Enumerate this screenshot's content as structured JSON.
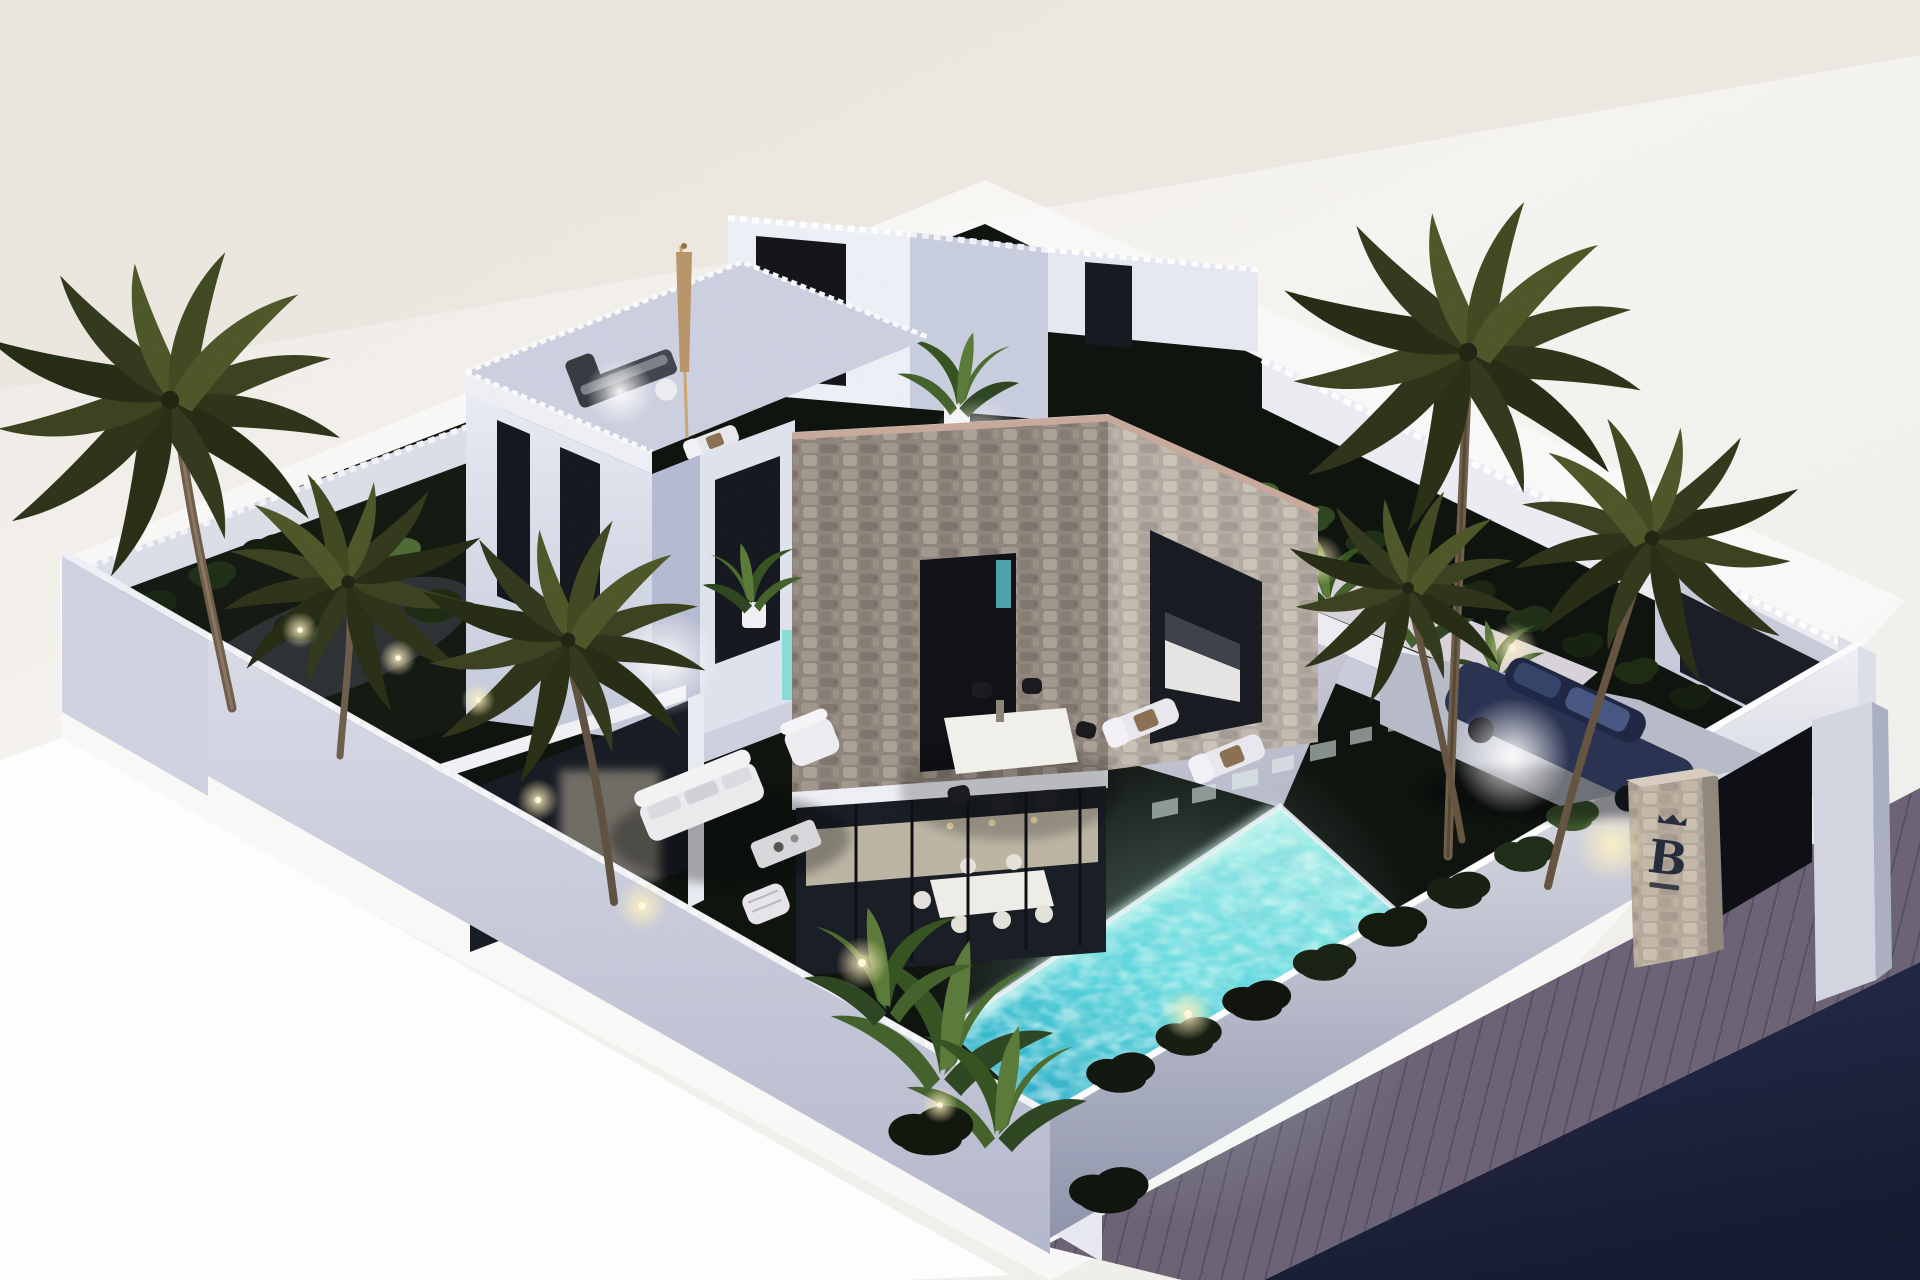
{
  "scene": {
    "title": "Villa B — 3D exterior render at dusk",
    "sign": {
      "letter": "B"
    },
    "palette": {
      "background": "#f2efea",
      "background_bright": "#fbfaf8",
      "lawn": "#0b100b",
      "garden_bed": "#11160f",
      "terrace": "#c9c9da",
      "porch_floor": "#cfd0e0",
      "walkway": "#d8d2da",
      "pool_light": "#aef4ea",
      "pool_deep": "#149bc0",
      "wall_face": "#c6c9d8",
      "wall_coping": "#f2f2f6",
      "house_white": "#eef0f7",
      "house_shade": "#c9cedf",
      "glass": "#161a22",
      "stone_base": "#a0958b",
      "road": "#1a1e38",
      "sidewalk": "#6a6174",
      "car_body": "#27304f",
      "palm_frond_dark": "#2c3117",
      "palm_frond_light": "#4c5526",
      "glow_warm": "#fff3c4",
      "sign_ink": "#222a3a"
    },
    "objects": [
      {
        "label": "modern villa with stone tower",
        "qty": 1
      },
      {
        "label": "roof terraces with lounge furniture",
        "qty": 2
      },
      {
        "label": "swimming pool (lit turquoise)",
        "qty": 1
      },
      {
        "label": "palm trees",
        "qty": 6
      },
      {
        "label": "sun loungers",
        "qty": 4
      },
      {
        "label": "outdoor dining chairs",
        "qty": 6
      },
      {
        "label": "garden lounge set",
        "qty": 1
      },
      {
        "label": "parked car in carport",
        "qty": 1
      },
      {
        "label": "stone entrance pillar with B sign",
        "qty": 1
      },
      {
        "label": "perimeter wall",
        "qty": 1
      },
      {
        "label": "sidewalk and road",
        "qty": 1
      }
    ]
  }
}
